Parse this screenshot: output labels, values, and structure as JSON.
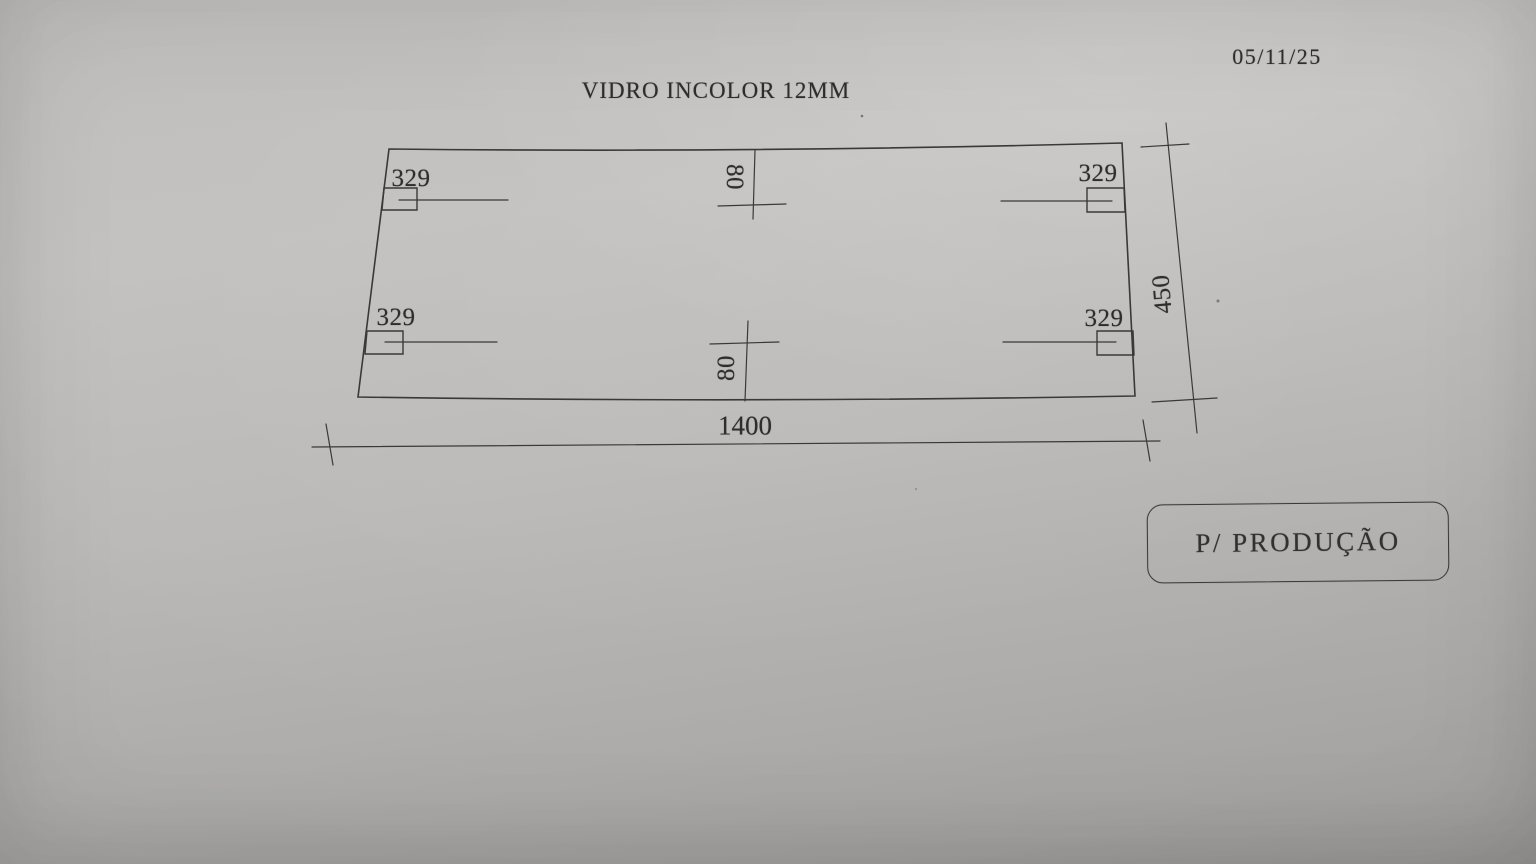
{
  "header": {
    "date": "05/11/25",
    "title": "VIDRO INCOLOR 12MM"
  },
  "drawing": {
    "type": "technical-drawing-glass-panel",
    "labels": {
      "width": "1400",
      "height": "450",
      "notch_top_left": "329",
      "notch_top_right": "329",
      "notch_bottom_left": "329",
      "notch_bottom_right": "329",
      "offset_top": "80",
      "offset_bottom": "80"
    },
    "colors": {
      "paper": "#bcbab8",
      "ink": "#3b3937"
    }
  },
  "stamp": {
    "label": "P/ PRODUÇÃO"
  }
}
